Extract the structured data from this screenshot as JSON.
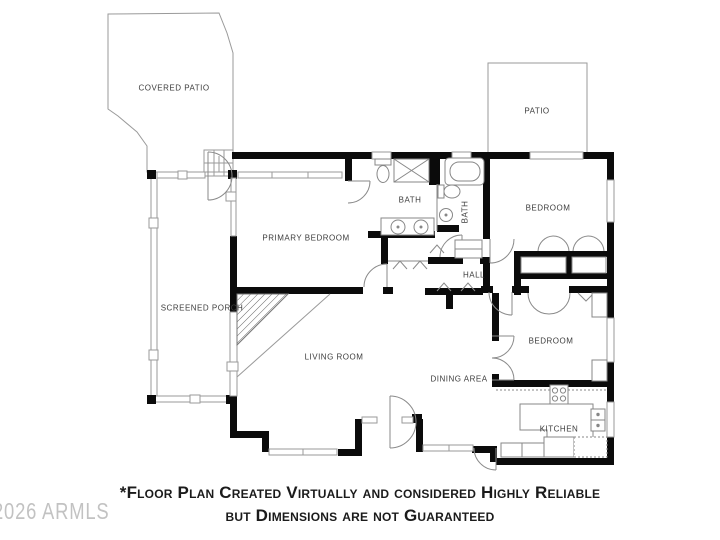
{
  "canvas": {
    "width": 720,
    "height": 540,
    "background": "#ffffff"
  },
  "colors": {
    "wall": "#0b0b0b",
    "thin_outline": "#9a9a9a",
    "fixture_line": "#878787",
    "room_label": "#3d3d3d",
    "disclaimer_text": "#1b1b1b",
    "watermark_text": "#bcbcbc"
  },
  "rooms": [
    {
      "id": "covered-patio",
      "label": "COVERED PATIO"
    },
    {
      "id": "patio",
      "label": "PATIO"
    },
    {
      "id": "primary-bedroom",
      "label": "PRIMARY BEDROOM"
    },
    {
      "id": "bath-primary",
      "label": "BATH"
    },
    {
      "id": "bath-hall",
      "label": "BATH"
    },
    {
      "id": "bedroom-ne",
      "label": "BEDROOM"
    },
    {
      "id": "hall",
      "label": "HALL"
    },
    {
      "id": "screened-porch",
      "label": "SCREENED PORCH"
    },
    {
      "id": "living-room",
      "label": "LIVING ROOM"
    },
    {
      "id": "dining-area",
      "label": "DINING AREA"
    },
    {
      "id": "bedroom-se",
      "label": "BEDROOM"
    },
    {
      "id": "kitchen",
      "label": "KITCHEN"
    }
  ],
  "disclaimer": {
    "line1": "*Floor Plan Created Virtually and considered Highly Reliable",
    "line2": "but Dimensions are not Guaranteed"
  },
  "watermark": "2026 ARMLS"
}
